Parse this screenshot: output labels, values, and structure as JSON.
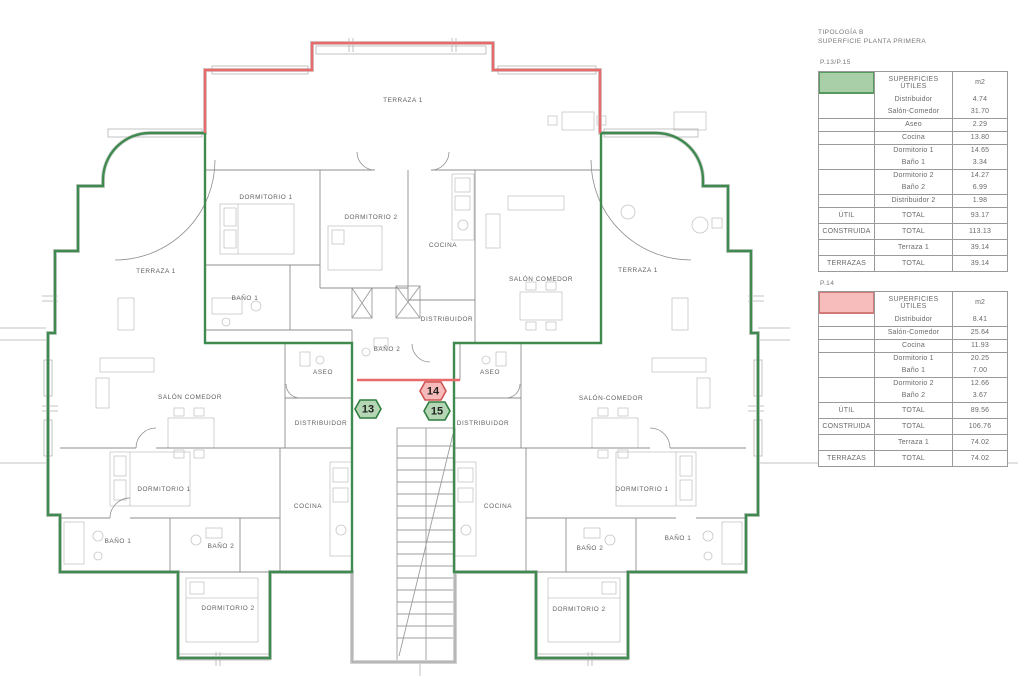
{
  "title_block": {
    "line1": "TIPOLOGÍA B",
    "line2": "SUPERFICIE PLANTA PRIMERA"
  },
  "tables": [
    {
      "units_label": "P.13/P.15",
      "swatch_fill": "#a9cfa9",
      "swatch_border": "#569a60",
      "header": {
        "title_line1": "SUPERFICIES",
        "title_line2": "ÚTILES",
        "unit_col": "m2"
      },
      "rows": [
        {
          "c1": "",
          "c2": "Distribuidor",
          "c3": "4.74",
          "kind": "plain"
        },
        {
          "c1": "",
          "c2": "Salón-Comedor",
          "c3": "31.70",
          "kind": "plain"
        },
        {
          "c1": "",
          "c2": "Aseo",
          "c3": "2.29",
          "kind": "sect"
        },
        {
          "c1": "",
          "c2": "Cocina",
          "c3": "13.80",
          "kind": "sect"
        },
        {
          "c1": "",
          "c2": "Dormitorio 1",
          "c3": "14.65",
          "kind": "sect"
        },
        {
          "c1": "",
          "c2": "Baño 1",
          "c3": "3.34",
          "kind": "plain"
        },
        {
          "c1": "",
          "c2": "Dormitorio 2",
          "c3": "14.27",
          "kind": "sect"
        },
        {
          "c1": "",
          "c2": "Baño 2",
          "c3": "6.99",
          "kind": "plain"
        },
        {
          "c1": "",
          "c2": "Distribuidor 2",
          "c3": "1.98",
          "kind": "sect"
        },
        {
          "c1": "ÚTIL",
          "c2": "TOTAL",
          "c3": "93.17",
          "kind": "sect total"
        },
        {
          "c1": "CONSTRUIDA",
          "c2": "TOTAL",
          "c3": "113.13",
          "kind": "sect total"
        },
        {
          "c1": "",
          "c2": "Terraza 1",
          "c3": "39.14",
          "kind": "sect total"
        },
        {
          "c1": "TERRAZAS",
          "c2": "TOTAL",
          "c3": "39.14",
          "kind": "sect total"
        }
      ]
    },
    {
      "units_label": "P.14",
      "swatch_fill": "#f7bcbc",
      "swatch_border": "#d17a7a",
      "header": {
        "title_line1": "SUPERFICIES",
        "title_line2": "ÚTILES",
        "unit_col": "m2"
      },
      "rows": [
        {
          "c1": "",
          "c2": "Distribuidor",
          "c3": "8.41",
          "kind": "plain"
        },
        {
          "c1": "",
          "c2": "Salón-Comedor",
          "c3": "25.64",
          "kind": "sect"
        },
        {
          "c1": "",
          "c2": "Cocina",
          "c3": "11.93",
          "kind": "sect"
        },
        {
          "c1": "",
          "c2": "Dormitorio 1",
          "c3": "20.25",
          "kind": "sect"
        },
        {
          "c1": "",
          "c2": "Baño 1",
          "c3": "7.00",
          "kind": "plain"
        },
        {
          "c1": "",
          "c2": "Dormitorio 2",
          "c3": "12.66",
          "kind": "sect"
        },
        {
          "c1": "",
          "c2": "Baño 2",
          "c3": "3.67",
          "kind": "plain"
        },
        {
          "c1": "ÚTIL",
          "c2": "TOTAL",
          "c3": "89.56",
          "kind": "sect total"
        },
        {
          "c1": "CONSTRUIDA",
          "c2": "TOTAL",
          "c3": "106.76",
          "kind": "sect total"
        },
        {
          "c1": "",
          "c2": "Terraza 1",
          "c3": "74.02",
          "kind": "sect total"
        },
        {
          "c1": "TERRAZAS",
          "c2": "TOTAL",
          "c3": "74.02",
          "kind": "sect total"
        }
      ]
    }
  ],
  "plan": {
    "labels": [
      "TERRAZA 1",
      "DORMITORIO 1",
      "DORMITORIO 2",
      "COCINA",
      "SALÓN COMEDOR",
      "TERRAZA 1",
      "TERRAZA 1",
      "BAÑO 1",
      "DISTRIBUIDOR",
      "BAÑO 2",
      "ASEO",
      "ASEO",
      "SALÓN COMEDOR",
      "SALÓN-COMEDOR",
      "DISTRIBUIDOR",
      "DISTRIBUIDOR",
      "DORMITORIO 1",
      "DORMITORIO 1",
      "COCINA",
      "COCINA",
      "BAÑO 1",
      "BAÑO 2",
      "BAÑO 2",
      "BAÑO 1",
      "DORMITORIO 2",
      "DORMITORIO 2"
    ],
    "badges": [
      {
        "number": "13",
        "type": "green"
      },
      {
        "number": "14",
        "type": "red"
      },
      {
        "number": "15",
        "type": "green"
      }
    ],
    "colors": {
      "unit_green": "#3f8b4f",
      "unit_red": "#e86a6a",
      "badge_green_fill": "#b5d6b5",
      "badge_green_border": "#2f7d3f",
      "badge_red_fill": "#f6baba",
      "badge_red_border": "#cf5454"
    }
  }
}
